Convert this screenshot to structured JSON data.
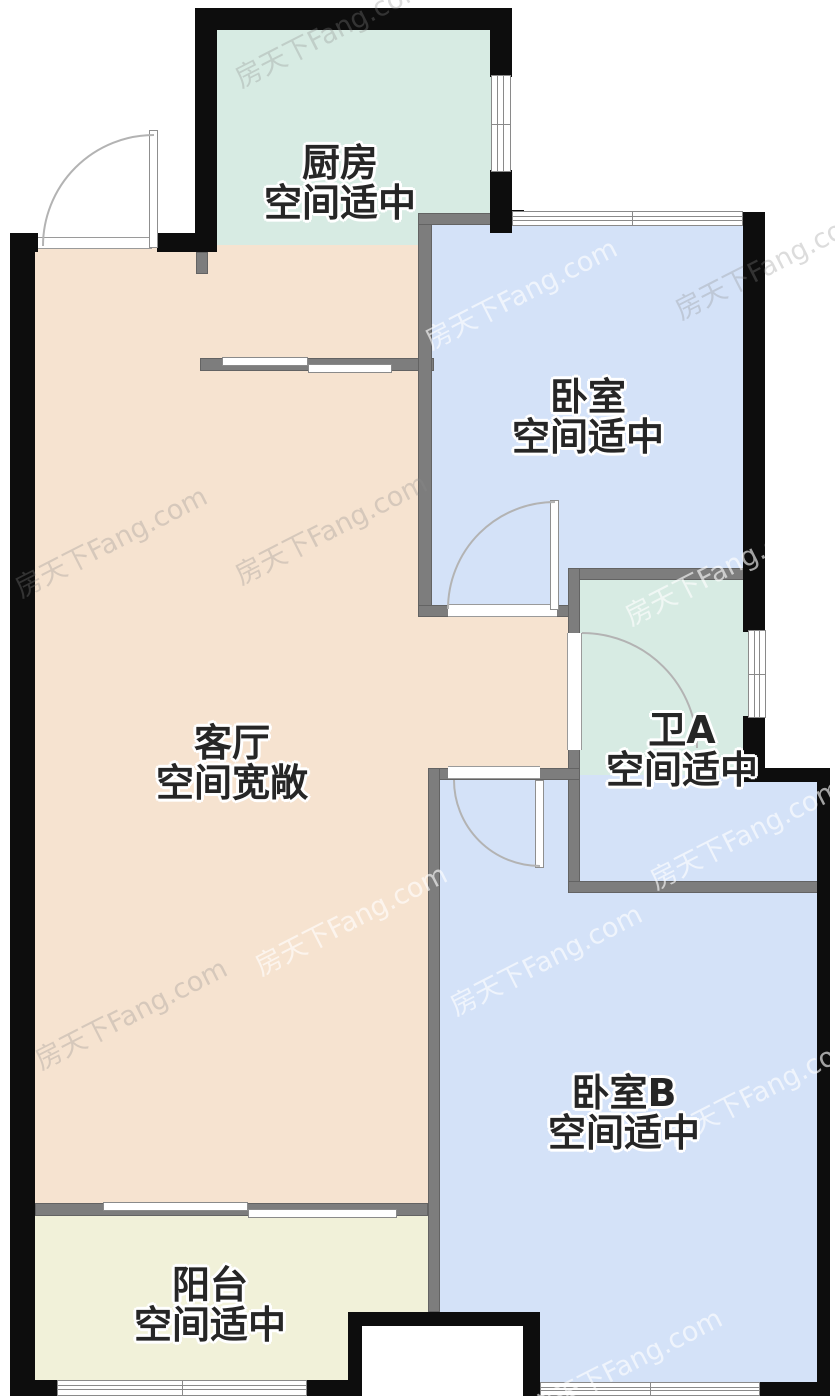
{
  "watermark": {
    "text": "房天下Fang.com"
  },
  "colors": {
    "exterior_wall": "#0d0d0d",
    "interior_wall": "#7d7d7d",
    "kitchen_fill": "#d7ebe3",
    "bathroom_fill": "#d7ebe3",
    "bedroom_fill": "#d4e2f8",
    "living_fill": "#f6e3d0",
    "balcony_fill": "#f1f1d9"
  },
  "rooms": {
    "kitchen": {
      "name": "厨房",
      "desc": "空间适中"
    },
    "bedroom_a": {
      "name": "卧室",
      "desc": "空间适中"
    },
    "living_room": {
      "name": "客厅",
      "desc": "空间宽敞"
    },
    "bath_a": {
      "name": "卫A",
      "desc": "空间适中"
    },
    "bedroom_b": {
      "name": "卧室B",
      "desc": "空间适中"
    },
    "balcony": {
      "name": "阳台",
      "desc": "空间适中"
    }
  }
}
